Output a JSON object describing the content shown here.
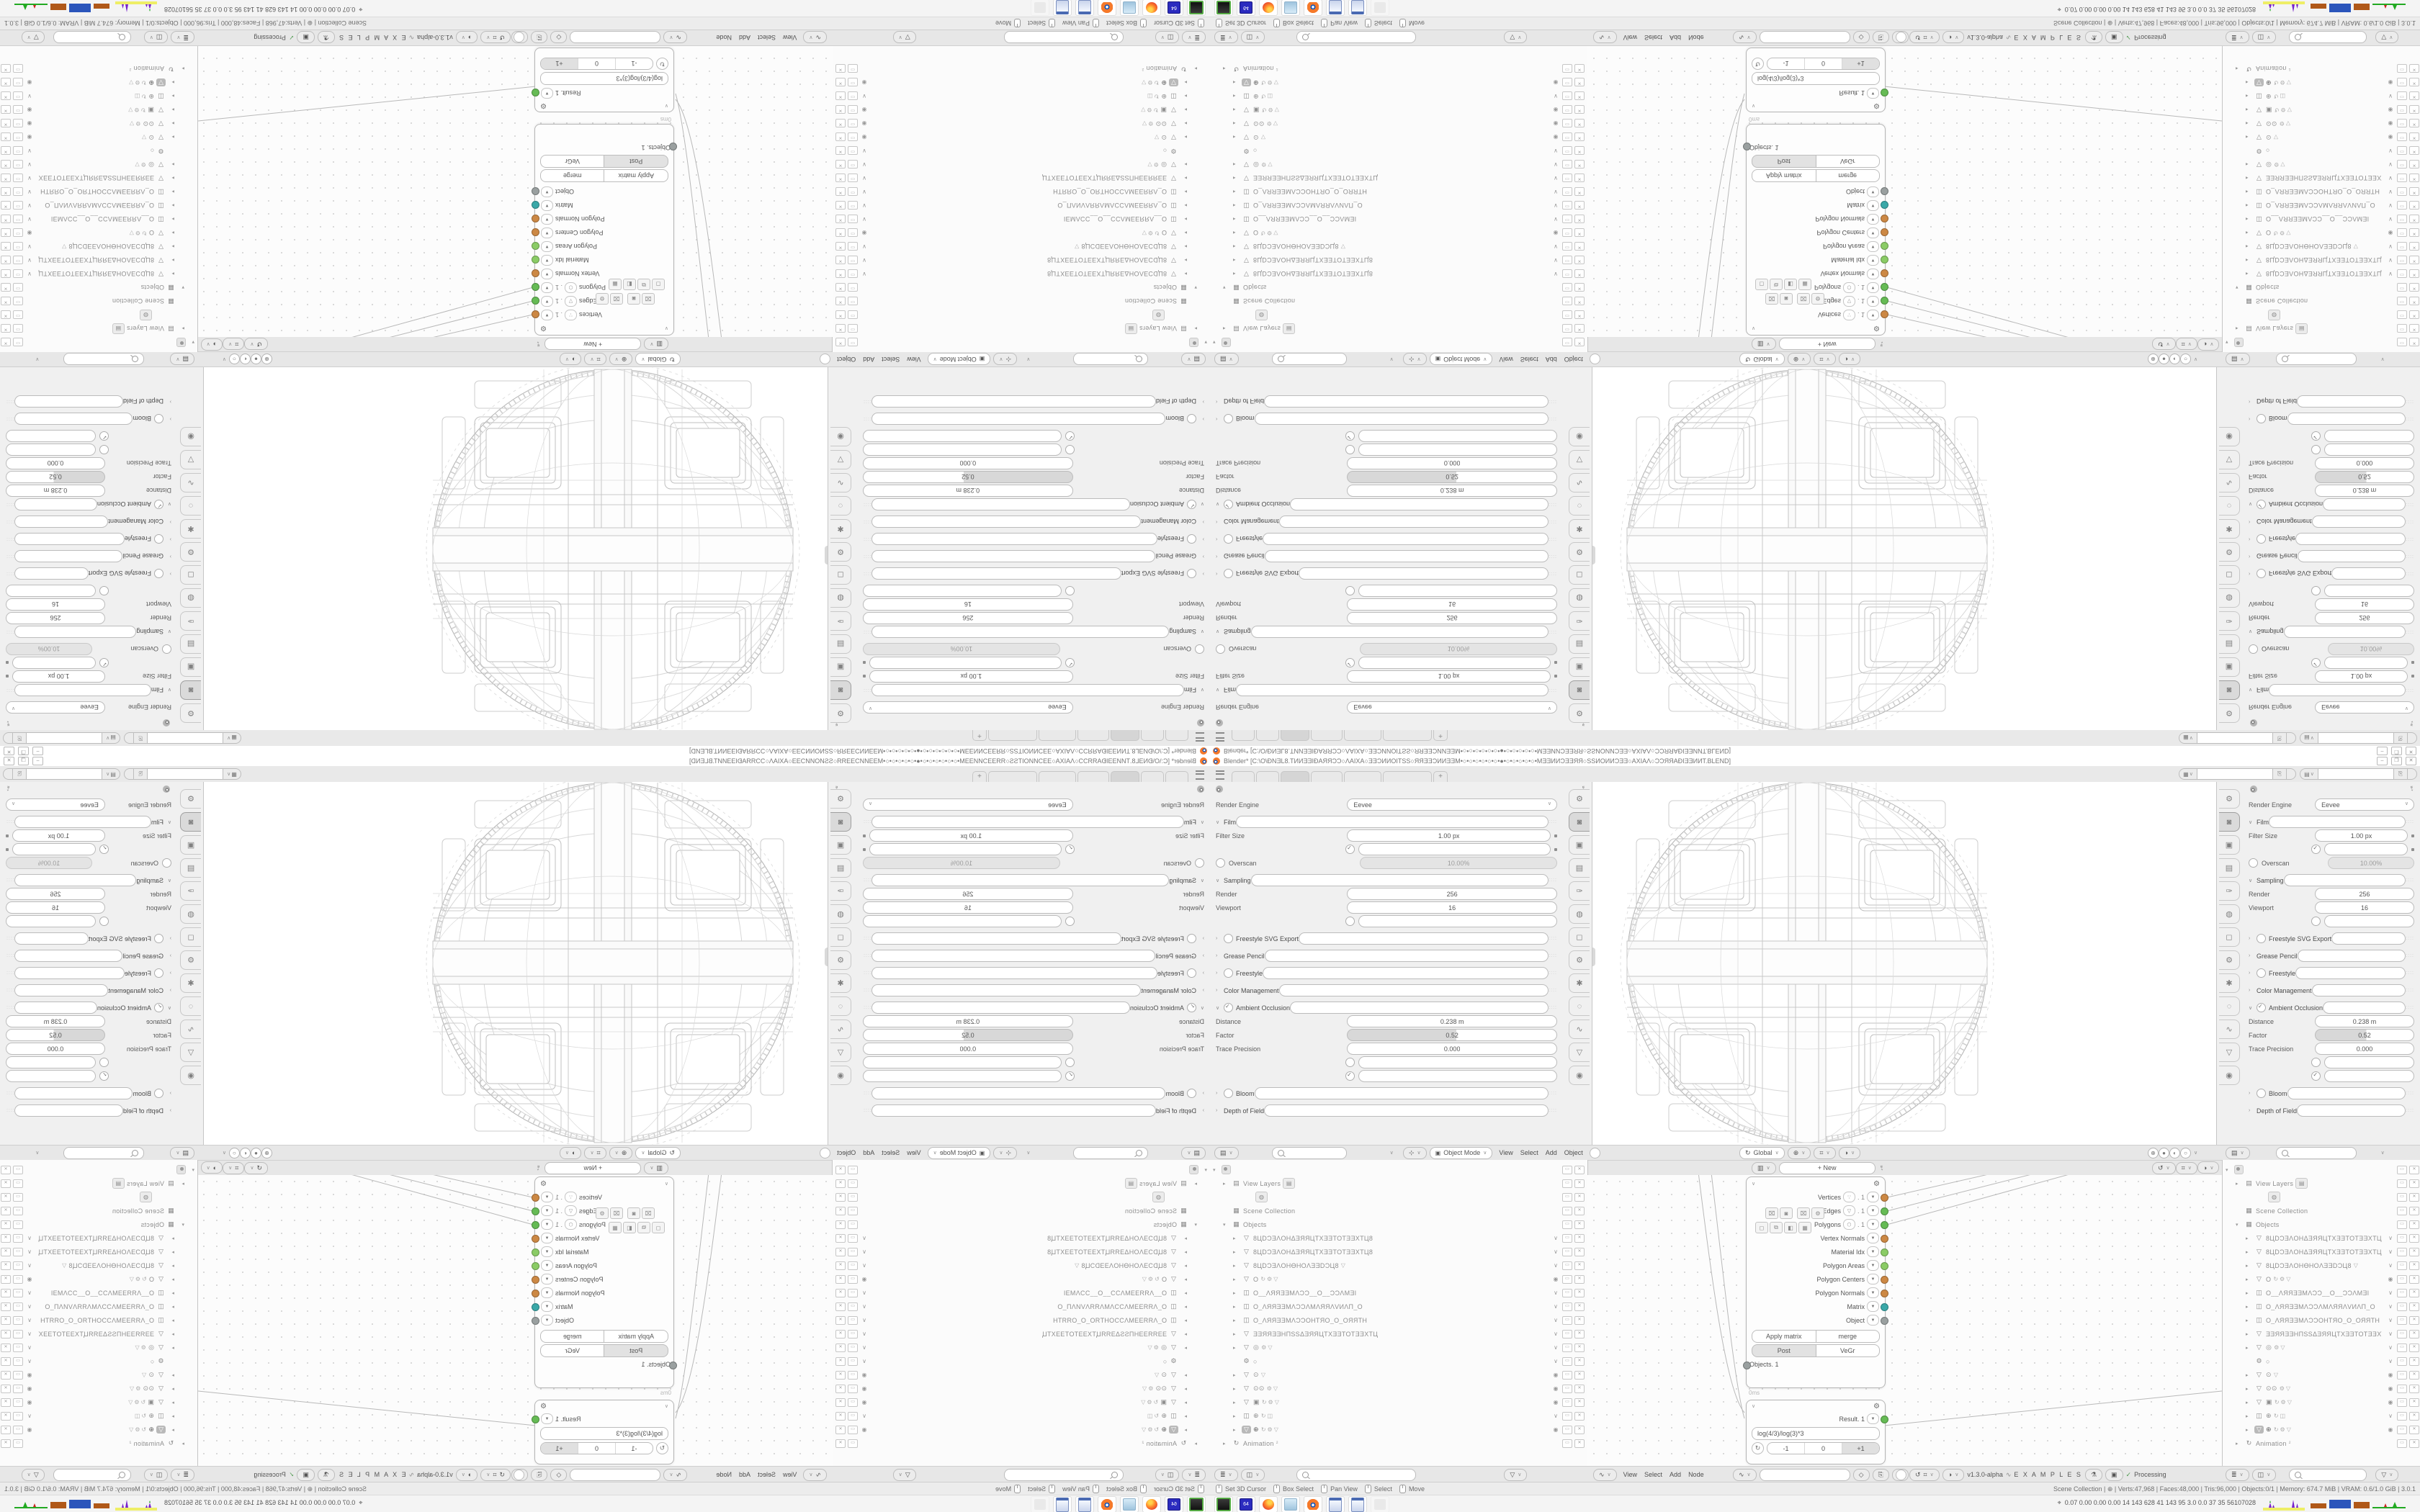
{
  "colors": {
    "accent_orange": "#f5792a",
    "socket_orange": "#cc8844",
    "socket_green": "#66bb55",
    "socket_lightgreen": "#8bcc66",
    "socket_teal": "#3aa8a8",
    "socket_gray": "#9aa0a0",
    "monitor_blue": "#2b55bb",
    "monitor_brown": "#b05818",
    "monitor_purple": "#7722cc",
    "monitor_yellow": "#eeee66",
    "monitor_green": "#22aa22"
  },
  "titlebar": {
    "title": "Blender* [C:\\O\\ĐNƎL8.TИИƎƎIĐAЯЯƆƆ○ΛAIXA○ƎƎƆИИOIТSS○ЯЯƎƎƆИИƎƎM•○•○•○•○•○•○•●•○•○•○•○•○•MƎƎИИƆƎƎЯЯ○SSИOИИƆƎƎ○AXIAΛ○ƆƆЯЯAĐIƎƎИИT.BLEND]",
    "minimize": "–",
    "restore": "❐",
    "close": "✕"
  },
  "topbar": {
    "new_tab": "+",
    "scene_icon": "▦",
    "viewlayer_icon": "▤",
    "copy_icon": "⎘"
  },
  "properties": {
    "pin_icon": "➴",
    "rows": [
      {
        "cls": "t-dropdown",
        "label": "Render Engine",
        "value": "Eevee"
      },
      {
        "cls": "t-section",
        "chev": "∨",
        "label": "Film"
      },
      {
        "cls": "t-field hasdot",
        "label": "Filter Size",
        "value": "1.00 px"
      },
      {
        "cls": "t-check on hasdot",
        "label": "Transparent"
      },
      {
        "cls": "t-ftog",
        "label": "Overscan",
        "value": "10.00%"
      },
      {
        "cls": "t-section",
        "chev": "∨",
        "label": "Sampling"
      },
      {
        "cls": "t-field",
        "label": "Render",
        "value": "256"
      },
      {
        "cls": "t-field",
        "label": "Viewport",
        "value": "16"
      },
      {
        "cls": "t-check",
        "label": "Viewport Denoising"
      },
      {
        "cls": "t-section hastog",
        "chev": "›",
        "label": "Freestyle SVG Export"
      },
      {
        "cls": "t-section",
        "chev": "›",
        "label": "Grease Pencil"
      },
      {
        "cls": "t-section hastog",
        "chev": "›",
        "label": "Freestyle"
      },
      {
        "cls": "t-section",
        "chev": "›",
        "label": "Color Management"
      },
      {
        "cls": "t-section hastog on",
        "chev": "∨",
        "label": "Ambient Occlusion"
      },
      {
        "cls": "t-field",
        "label": "Distance",
        "value": "0.238 m"
      },
      {
        "cls": "t-slider",
        "label": "Factor",
        "value": "0.52"
      },
      {
        "cls": "t-field",
        "label": "Trace Precision",
        "value": "0.000"
      },
      {
        "cls": "t-check",
        "label": "Bent Normals"
      },
      {
        "cls": "t-check on",
        "label": "Bounces Approximation"
      },
      {
        "cls": "t-section hastog",
        "chev": "›",
        "label": "Bloom"
      },
      {
        "cls": "t-section",
        "chev": "›",
        "label": "Depth of Field"
      }
    ],
    "tabs": [
      {
        "g": "⚙",
        "cls": "t"
      },
      {
        "g": "◙",
        "cls": "active"
      },
      {
        "g": "▣",
        "cls": "t"
      },
      {
        "g": "▤",
        "cls": "t"
      },
      {
        "g": "✑",
        "cls": "t"
      },
      {
        "g": "◍",
        "cls": "t"
      },
      {
        "g": "◻",
        "cls": "t"
      },
      {
        "g": "⚙",
        "cls": "t"
      },
      {
        "g": "✱",
        "cls": "t"
      },
      {
        "g": "◌",
        "cls": "t"
      },
      {
        "g": "∿",
        "cls": "t"
      },
      {
        "g": "▽",
        "cls": "t"
      },
      {
        "g": "◉",
        "cls": "t"
      }
    ]
  },
  "viewport_header": {
    "gizmo_icon": "⊹",
    "mode": "Object Mode",
    "menus": [
      {
        "label": "View"
      },
      {
        "label": "Select"
      },
      {
        "label": "Add"
      },
      {
        "label": "Object"
      }
    ],
    "orientation": "Global",
    "orient_icon": "↻",
    "pivot_icon": "⊕",
    "snap_icon": "⌗",
    "prop_icon": "◑",
    "shading": [
      {
        "g": "⊕"
      },
      {
        "g": "●"
      },
      {
        "g": "◐"
      },
      {
        "g": "○"
      }
    ]
  },
  "outliner": {
    "filter_icon": "▤",
    "filter2_icon": "≣",
    "person_icon": "◫",
    "funnel_icon": "▽",
    "search_placeholder": "",
    "rows": [
      {
        "cls": "p0",
        "exp": "▾",
        "logo": true,
        "label": ""
      },
      {
        "cls": "p1",
        "exp": "▸",
        "icon": "▤",
        "label": "View Layers",
        "chip": "▤"
      },
      {
        "cls": "p2",
        "icon": "",
        "label": "",
        "chip": "◍"
      },
      {
        "cls": "p1",
        "icon": "▦",
        "label": "Scene Collection"
      },
      {
        "cls": "p1",
        "exp": "▾",
        "icon": "▦",
        "label": "Objects"
      },
      {
        "cls": "p2",
        "exp": "▸",
        "icon": "▽",
        "label": "8ЦDƆƎΛOHΔƎЯЯЦTXƎƎTOTƎƎXTЦ8",
        "r1": "∨"
      },
      {
        "cls": "p2",
        "exp": "▸",
        "icon": "▽",
        "label": "8ЦDƆƎΛOHΔƎЯЯЦTXƎƎTOTƎƎXTЦ8",
        "r1": "∨"
      },
      {
        "cls": "p2",
        "exp": "▸",
        "icon": "▽",
        "label": "8ЦDƆƎΛOHƟHOΛƎƎDƆЦ8",
        "mid": "▽",
        "r1": "∨"
      },
      {
        "cls": "p2",
        "exp": "▸",
        "icon": "▽",
        "label": "O",
        "mid": "↻⚙▽",
        "r1": "◉"
      },
      {
        "cls": "p2",
        "exp": "▸",
        "icon": "◫",
        "label": "O__ΛЯЯƎƎMΛƆƆ__O__ƆƆΛMƎI",
        "r1": "∨"
      },
      {
        "cls": "p2",
        "exp": "▸",
        "icon": "◫",
        "label": "O_ΛЯЯƎƎMΛƆƆΛMΛЯЯΛVИΛП_O",
        "r1": "∨"
      },
      {
        "cls": "p2",
        "exp": "▸",
        "icon": "◫",
        "label": "O_ΛЯЯƎƎMΛƆƆOHTЯO_O_OЯЯTH",
        "r1": "∨"
      },
      {
        "cls": "p2",
        "exp": "▸",
        "icon": "▽",
        "label": "ƎƎЯЯƎƎHПSSΔƎЯЯЦTXƎƎTOTƎƎXTЦ",
        "r1": "∨"
      },
      {
        "cls": "p2",
        "exp": "▸",
        "icon": "▽",
        "label": "◎",
        "mid": "⚙▽",
        "r1": "∨"
      },
      {
        "cls": "p2",
        "icon": "⚙",
        "label": "○",
        "r1": "∨"
      },
      {
        "cls": "p2",
        "exp": "▸",
        "icon": "▽",
        "label": "⊙",
        "mid": "▽",
        "r1": "◉"
      },
      {
        "cls": "p2",
        "exp": "▸",
        "icon": "▽",
        "label": "⊙⊙",
        "mid": "⚙▽",
        "r1": "◉"
      },
      {
        "cls": "p2",
        "exp": "▸",
        "icon": "▽",
        "label": "▣",
        "mid": "↻⚙▽",
        "r1": "◉"
      },
      {
        "cls": "p2",
        "exp": "▸",
        "icon": "◫",
        "label": "⊕",
        "mid": "↻◫",
        "r1": "∨"
      },
      {
        "cls": "p2 hl",
        "exp": "▸",
        "icon": "▽",
        "label": "⊕",
        "mid": "↻⚙▽",
        "r1": "◉"
      },
      {
        "cls": "p1",
        "exp": "▸",
        "icon": "↻",
        "label": "Animation",
        "mid": "²"
      }
    ]
  },
  "node_editor": {
    "editor_icon": "▥",
    "menus": [
      {
        "label": "View"
      },
      {
        "label": "Select"
      },
      {
        "label": "Add"
      },
      {
        "label": "Node"
      }
    ],
    "new_button": "+        New",
    "pin_icon": "➴",
    "snap_icons": [
      {
        "g": "↺"
      },
      {
        "g": "⌗"
      },
      {
        "g": "◑"
      }
    ],
    "sv_icon": "∿",
    "shield_icon": "◇",
    "copy_icon": "⎘",
    "x_icon": "✕",
    "version": "v1.3.0-alpha",
    "examples": "E X A M P L E S",
    "flask_icon": "⚗",
    "monitor_icon": "▣",
    "check": "✓",
    "processing": "Processing",
    "objects_node": {
      "outputs": [
        {
          "label": "Vertices",
          "chip": "∵",
          "idx": ". 1",
          "color": "#cc8844"
        },
        {
          "label": "Edges",
          "chip": "▽",
          "idx": ". 1",
          "color": "#66bb55"
        },
        {
          "label": "Polygons",
          "chip": "⬡",
          "idx": ". 1",
          "color": "#66bb55"
        },
        {
          "label": "Vertex Normals",
          "color": "#cc8844"
        },
        {
          "label": "Material Idx",
          "color": "#8bcc66"
        },
        {
          "label": "Polygon Areas",
          "color": "#8bcc66"
        },
        {
          "label": "Polygon Centers",
          "color": "#cc8844"
        },
        {
          "label": "Polygon Normals",
          "color": "#cc8844"
        },
        {
          "label": "Matrix",
          "color": "#3aa8a8"
        },
        {
          "label": "Object",
          "color": "#9aa0a0"
        }
      ],
      "tool_icons_a": [
        {
          "g": "⌧"
        },
        {
          "g": "◙"
        }
      ],
      "tool_icons_b": [
        {
          "g": "⌧"
        },
        {
          "g": "⚙"
        }
      ],
      "tool_icons_c": [
        {
          "g": "◻"
        },
        {
          "g": "⧉"
        },
        {
          "g": "◧"
        },
        {
          "g": "▦"
        }
      ],
      "btn_apply": "Apply matrix",
      "btn_merge": "merge",
      "btn_post": "Post",
      "btn_vegr": "VeGr",
      "input_socket": "Objects. 1",
      "time": "0ms"
    },
    "formula_node": {
      "output": "Result. 1",
      "formula": "log(4/3)/log(3)*3",
      "steps": [
        {
          "label": "-1",
          "cls": "s"
        },
        {
          "label": "0",
          "cls": "s"
        },
        {
          "label": "+1",
          "cls": "selseg"
        }
      ]
    }
  },
  "statusbar": {
    "hints": [
      {
        "label": "Set 3D Cursor"
      },
      {
        "label": "Box Select"
      },
      {
        "label": "Pan View"
      },
      {
        "label": "Select"
      },
      {
        "label": "Move"
      }
    ],
    "stats": "Scene Collection  |  ⊕  |  Verts:47,968  |  Faces:48,000  |  Tris:96,000  |  Objects:0/1  |  Memory: 674.7 MiB  |  VRAM: 0.6/1.0 GiB  |  3.0.1"
  },
  "taskbar": {
    "apps": [
      {
        "cls": "app-zx",
        "label": ""
      },
      {
        "cls": "app-64",
        "label": "64"
      },
      {
        "cls": "app-ff",
        "label": ""
      },
      {
        "cls": "app-note",
        "label": ""
      },
      {
        "cls": "app-blend",
        "label": ""
      },
      {
        "cls": "app-calc",
        "label": ""
      },
      {
        "cls": "app-calc",
        "label": ""
      },
      {
        "cls": "app-ghost",
        "label": ""
      }
    ],
    "monitor_label": "⌖",
    "stats": "0.07 0.00 0.00 0.00   14   143   628   41   143   95   3.0   0.0   37   35   56107028"
  }
}
